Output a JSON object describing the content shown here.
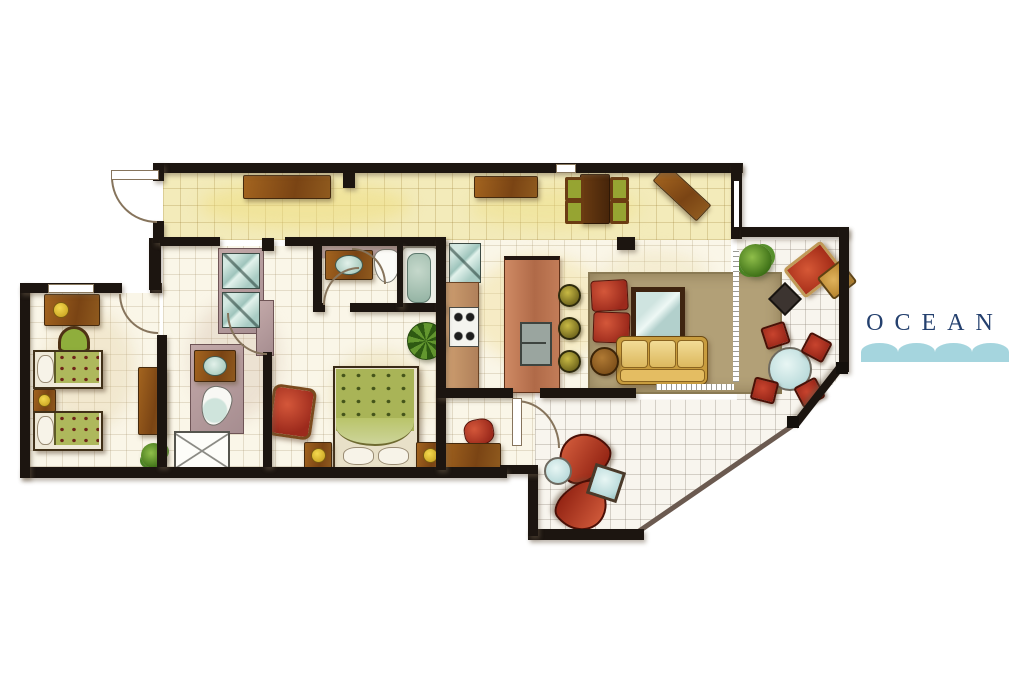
{
  "logo": {
    "text": "OCEAN",
    "text_color": "#24406e",
    "wave_color": "#a5d5de"
  },
  "palette": {
    "wall": "#1c1510",
    "tile_cream": "#faf6e8",
    "tile_yellow": "#f3ebba",
    "tile_terrace": "#f8f5ee",
    "accent_wall_mauve": "#b39a9c",
    "wood": "#8a5420",
    "upholstery_red": "#b03522",
    "sofa_yellow": "#e4bd62",
    "rug_tan": "#b2a077",
    "bedding_green": "#a9b457",
    "glass_blue": "#bcdcdc"
  },
  "floor_plan": {
    "style": "hand-rendered watercolor apartment floor plan, top view, ocean-facing",
    "rooms": [
      {
        "name": "entry-hall",
        "furniture": [
          "entry-door",
          "hall-bench",
          "mirrored-wardrobe"
        ]
      },
      {
        "name": "corridor-dining",
        "furniture": [
          "sideboard",
          "dining-table",
          "dining-chair x4",
          "corner-console"
        ]
      },
      {
        "name": "living-room",
        "furniture": [
          "area-rug",
          "red-armchair x2",
          "glass-coffee-table",
          "three-seat-sofa",
          "round-side-table"
        ]
      },
      {
        "name": "kitchen",
        "furniture": [
          "refrigerator",
          "range-cooktop",
          "counter",
          "island-with-double-sink",
          "bar-stool x3"
        ]
      },
      {
        "name": "bathroom",
        "furniture": [
          "vanity-sink",
          "bidet",
          "bathtub"
        ]
      },
      {
        "name": "hall-bathroom",
        "furniture": [
          "vanity-sink",
          "toilet",
          "shower-stall"
        ]
      },
      {
        "name": "master-bedroom",
        "furniture": [
          "canopy-double-bed",
          "nightstand x2",
          "red-armchair",
          "red-ottoman",
          "foot-bench",
          "palm-plant"
        ]
      },
      {
        "name": "twin-bedroom",
        "furniture": [
          "desk",
          "desk-chair",
          "twin-bed x2",
          "nightstand",
          "dresser",
          "plant"
        ]
      },
      {
        "name": "upper-balcony",
        "furniture": [
          "plant",
          "red-lounge-chair",
          "side-chair",
          "side-table",
          "round-table",
          "terrace-chair x4"
        ]
      },
      {
        "name": "lower-balcony",
        "furniture": [
          "curved-lounge x2",
          "round-glass-table",
          "square-glass-table"
        ]
      }
    ]
  }
}
